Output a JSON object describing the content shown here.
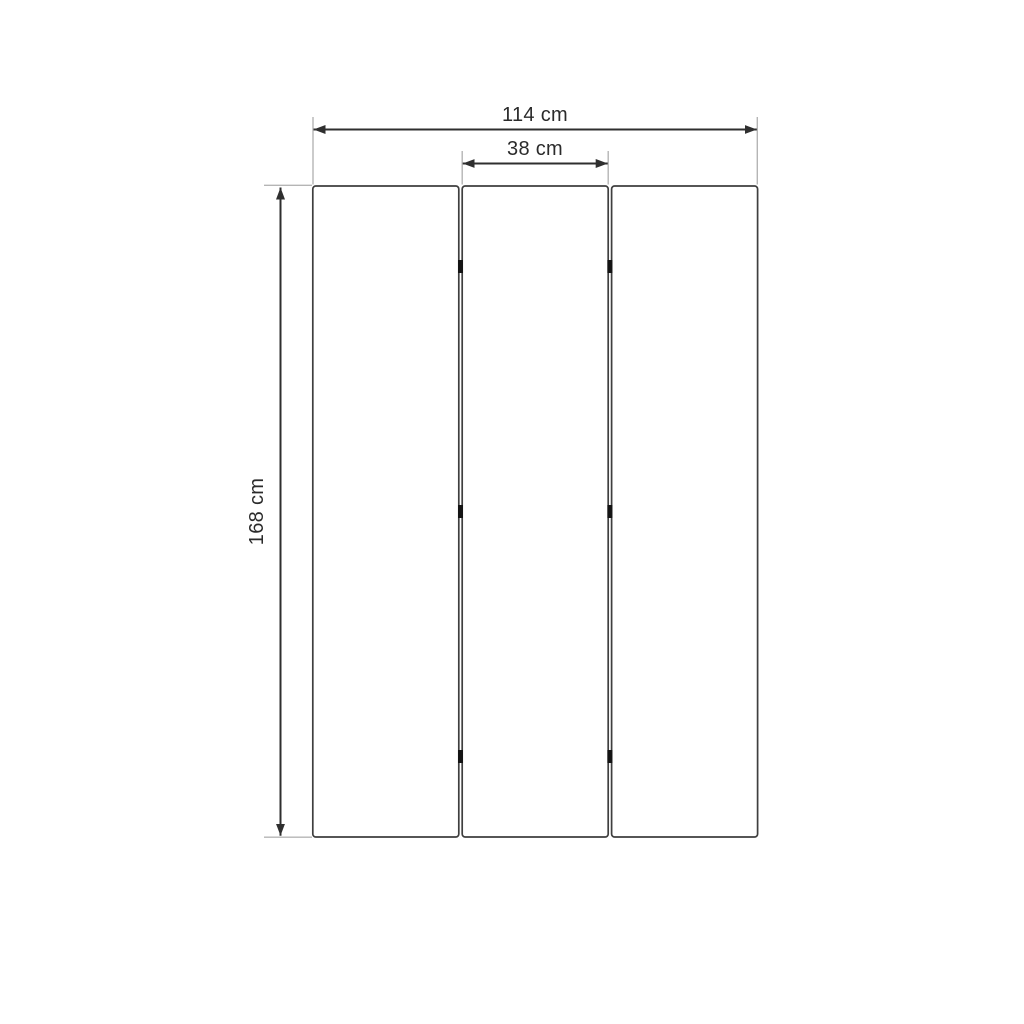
{
  "diagram": {
    "kind": "product-dimension-drawing",
    "subject": "three-panel-folding-screen-front-view",
    "panel_count": 3,
    "hinge_count": 6,
    "dimensions": {
      "total_width_label": "114 cm",
      "panel_width_label": "38 cm",
      "height_label": "168 cm"
    },
    "colors": {
      "background": "#ffffff",
      "panel_fill": "#ffffff",
      "panel_stroke": "#3f3f3f",
      "dimension_line": "#2f2f2f",
      "extension_line": "#b5b5b5",
      "hinge": "#141414",
      "label_text": "#2b2b2b"
    }
  }
}
